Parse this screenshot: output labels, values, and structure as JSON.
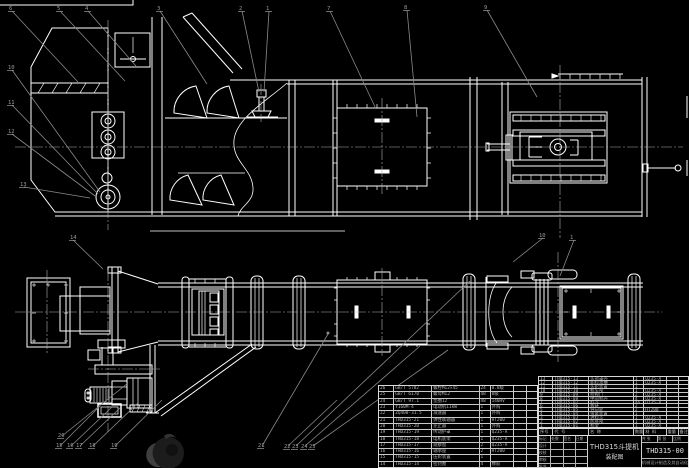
{
  "meta": {
    "background": "#000000",
    "line_color": "#ffffff",
    "leader_color": "#8a8a8a",
    "table_text_color": "#b5b5b5",
    "watermark_color": "#2a2a2a"
  },
  "title_block": {
    "product": "THD315斗提机",
    "doc_type": "装配图",
    "drawing_no": "THD315-00",
    "org": "机械设计制造及其自动化",
    "sheet_info": [
      "共 张",
      "第 张",
      "比例"
    ],
    "sig_rows": [
      [
        "标记",
        "处数",
        "签名",
        "日期"
      ],
      [
        "设计",
        "",
        "",
        ""
      ],
      [
        "校核",
        "",
        "",
        ""
      ],
      [
        "审核",
        "",
        "",
        ""
      ],
      [
        "批准",
        "",
        "",
        ""
      ]
    ]
  },
  "bom": {
    "header": [
      "序号",
      "代 号",
      "名  称",
      "数量",
      "材 料",
      "重量",
      "备注"
    ],
    "right_rows": [
      [
        "13",
        "THD315-13",
        "头部罩壳",
        "1",
        "Q235-A",
        "",
        ""
      ],
      [
        "12",
        "THD315-12",
        "卸料溜槽",
        "1",
        "Q235-A",
        "",
        ""
      ],
      [
        "11",
        "THD315-11",
        "头轮装置",
        "1",
        "",
        "",
        ""
      ],
      [
        "10",
        "THD315-10",
        "机头部",
        "1",
        "Q235-A",
        "",
        ""
      ],
      [
        "9",
        "THD315-09",
        "检视门",
        "2",
        "Q235-A",
        "",
        ""
      ],
      [
        "8",
        "THD315-08",
        "中间机壳",
        "4",
        "Q235-A",
        "",
        ""
      ],
      [
        "7",
        "THD315-07",
        "料斗",
        "46",
        "Q235-A",
        "",
        ""
      ],
      [
        "6",
        "THD315-06",
        "板链",
        "2",
        "",
        "",
        ""
      ],
      [
        "5",
        "THD315-05",
        "导向轮",
        "2",
        "HT200",
        "",
        ""
      ],
      [
        "4",
        "THD315-04",
        "张紧装置",
        "1",
        "",
        "",
        ""
      ],
      [
        "3",
        "THD315-03",
        "进料斗",
        "1",
        "Q235-A",
        "",
        ""
      ],
      [
        "2",
        "THD315-02",
        "底座部",
        "1",
        "Q235-A",
        "",
        ""
      ],
      [
        "1",
        "THD315-01",
        "机架",
        "1",
        "Q235-A",
        "",
        ""
      ]
    ],
    "left_rows": [
      [
        "26",
        "GB/T 5782",
        "螺栓M12×45",
        "24",
        "8.8级",
        "",
        ""
      ],
      [
        "25",
        "GB/T 6170",
        "螺母M12",
        "48",
        "8级",
        "",
        ""
      ],
      [
        "24",
        "GB/T 97.1",
        "垫圈12",
        "48",
        "140HV",
        "",
        ""
      ],
      [
        "23",
        "Y160M-4",
        "电动机11kW",
        "1",
        "外购",
        "",
        ""
      ],
      [
        "22",
        "ZQ400-31.5",
        "减速器",
        "1",
        "外购",
        "",
        ""
      ],
      [
        "21",
        "THD315-21",
        "弹性联轴器",
        "1",
        "HT200",
        "",
        ""
      ],
      [
        "20",
        "THD315-20",
        "逆止器",
        "1",
        "外购",
        "",
        ""
      ],
      [
        "19",
        "THD315-19",
        "传动护罩",
        "1",
        "Q235-A",
        "",
        ""
      ],
      [
        "18",
        "THD315-18",
        "电机底架",
        "1",
        "Q235-A",
        "",
        ""
      ],
      [
        "17",
        "THD315-17",
        "观察窗",
        "2",
        "Q235-A",
        "",
        ""
      ],
      [
        "16",
        "THD315-16",
        "轴承座",
        "2",
        "HT200",
        "",
        ""
      ],
      [
        "15",
        "THD315-15",
        "压轮装置",
        "1",
        "",
        "",
        ""
      ],
      [
        "14",
        "THD315-14",
        "密封圈",
        "4",
        "橡胶",
        "",
        ""
      ]
    ]
  },
  "callouts": [
    {
      "n": "6",
      "x": 9,
      "y": 10
    },
    {
      "n": "5",
      "x": 57,
      "y": 10
    },
    {
      "n": "4",
      "x": 85,
      "y": 10
    },
    {
      "n": "3",
      "x": 157,
      "y": 10
    },
    {
      "n": "2",
      "x": 239,
      "y": 10
    },
    {
      "n": "1",
      "x": 266,
      "y": 10
    },
    {
      "n": "7",
      "x": 327,
      "y": 10
    },
    {
      "n": "8",
      "x": 404,
      "y": 9
    },
    {
      "n": "9",
      "x": 484,
      "y": 9
    },
    {
      "n": "10",
      "x": 8,
      "y": 69
    },
    {
      "n": "11",
      "x": 8,
      "y": 104
    },
    {
      "n": "12",
      "x": 8,
      "y": 133
    },
    {
      "n": "13",
      "x": 20,
      "y": 186
    },
    {
      "n": "14",
      "x": 70,
      "y": 239
    },
    {
      "n": "20",
      "x": 58,
      "y": 437
    },
    {
      "n": "15",
      "x": 56,
      "y": 447
    },
    {
      "n": "16",
      "x": 67,
      "y": 447
    },
    {
      "n": "17",
      "x": 76,
      "y": 447
    },
    {
      "n": "18",
      "x": 89,
      "y": 447
    },
    {
      "n": "19",
      "x": 111,
      "y": 447
    },
    {
      "n": "21",
      "x": 258,
      "y": 447
    },
    {
      "n": "22",
      "x": 284,
      "y": 448
    },
    {
      "n": "23",
      "x": 292,
      "y": 448
    },
    {
      "n": "24",
      "x": 301,
      "y": 448
    },
    {
      "n": "25",
      "x": 309,
      "y": 448
    },
    {
      "n": "1",
      "x": 570,
      "y": 239
    },
    {
      "n": "10",
      "x": 539,
      "y": 237
    }
  ]
}
